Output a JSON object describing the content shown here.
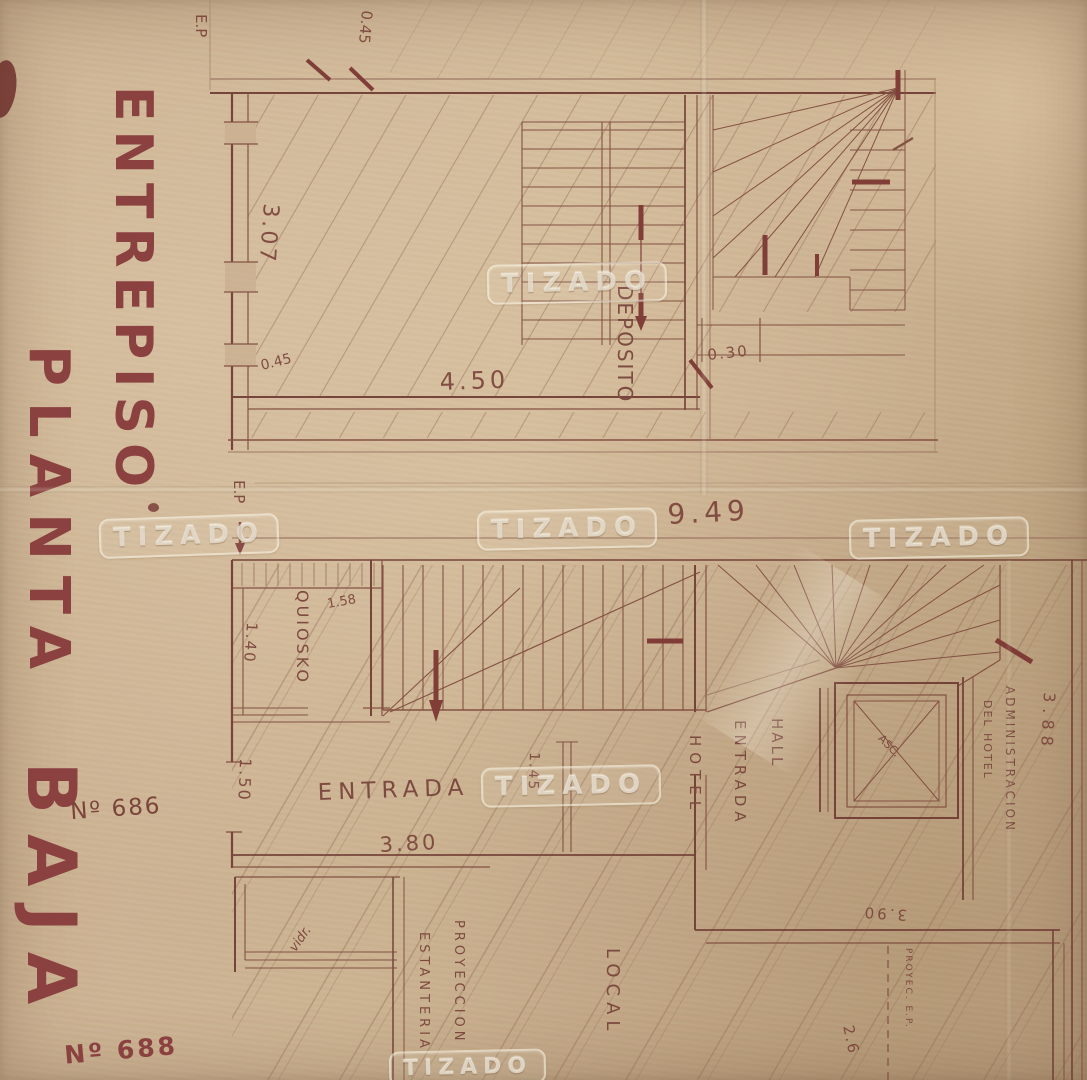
{
  "watermark": {
    "text": "TIZADO"
  },
  "titles": {
    "entrepiso": "ENTREPISO",
    "planta": "PLANTA",
    "baja": "BAJA",
    "numero_686": "Nº 686",
    "numero_688": "Nº 688"
  },
  "entrepiso": {
    "ep_marker": "E.P",
    "room_deposito": "DEPOSITO",
    "dim_045_top": "0.45",
    "dim_307": "3.07",
    "dim_045_wall": "0.45",
    "dim_450": "4.50",
    "dim_030": "0.30"
  },
  "planta_baja": {
    "dim_949": "9.49",
    "kiosko_label": "QUIOSKO",
    "dim_158": "1.58",
    "dim_140": "1.40",
    "dim_150": "1.50",
    "entrada_label": "ENTRADA",
    "dim_380": "3.80",
    "dim_145": "1.45",
    "hall_label": "HALL",
    "hall_entrada_label": "ENTRADA",
    "hotel_label": "HOTEL",
    "ascensor_label": "ASC.",
    "administracion_label": "ADMINISTRACION",
    "del_hotel_label": "DEL HOTEL",
    "dim_388": "3.88",
    "vidriera_label": "vidr.",
    "proyeccion_label": "PROYECCION",
    "estanteria_label": "ESTANTERIA",
    "local_label": "LOCAL",
    "dim_390": "3.90",
    "proyec_ep_label": "PROYEC. E.P.",
    "dim_26": "2.6"
  }
}
